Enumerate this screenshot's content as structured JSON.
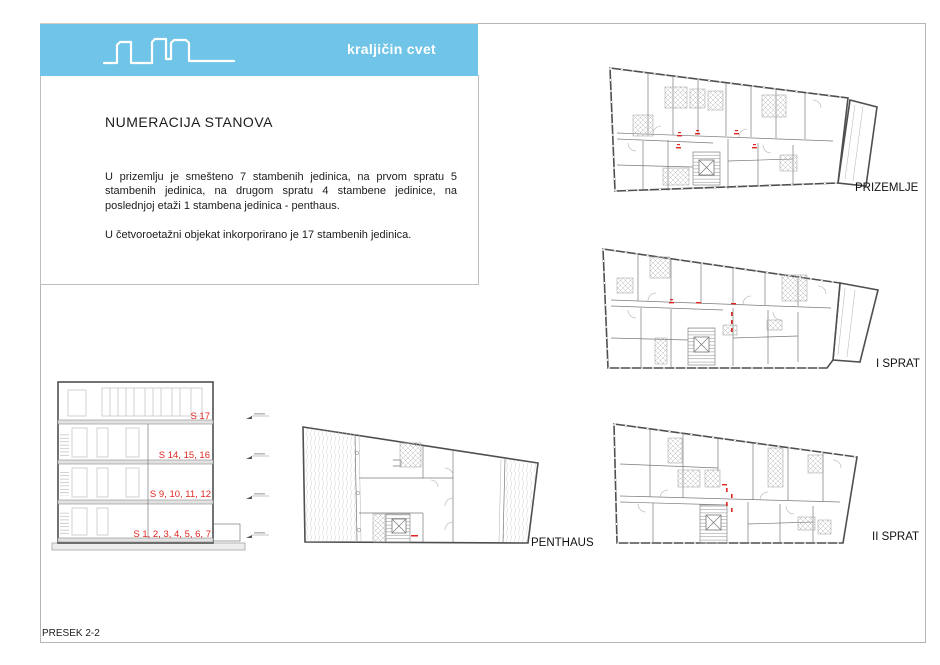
{
  "header": {
    "project_title": "kraljičin cvet",
    "logo": "skyline-icon",
    "banner_color": "#6FC4E7"
  },
  "info_panel": {
    "title": "NUMERACIJA STANOVA",
    "paragraphs": [
      "U prizemlju je smešteno 7 stambenih jedinica, na prvom spratu 5 stambenih jedinica, na drugom spratu 4 stambene jedinice, na poslednjoj etaži 1 stambena jedinica - penthaus.",
      "U četvoroetažni objekat inkorporirano je 17 stambenih jedinica."
    ]
  },
  "section_drawing": {
    "caption": "PRESEK 2-2",
    "floor_labels": [
      "S 17",
      "S 14, 15, 16",
      "S 9, 10, 11, 12",
      "S 1, 2, 3, 4, 5, 6, 7"
    ]
  },
  "floor_plans": [
    {
      "label": "PRIZEMLJE"
    },
    {
      "label": "I SPRAT"
    },
    {
      "label": "II SPRAT"
    },
    {
      "label": "PENTHAUS"
    }
  ],
  "colors": {
    "banner_blue": "#6FC4E7",
    "apartment_red": "#E02620",
    "linework_gray": "#4F4F4F",
    "frame_gray": "#B5B5B5"
  }
}
